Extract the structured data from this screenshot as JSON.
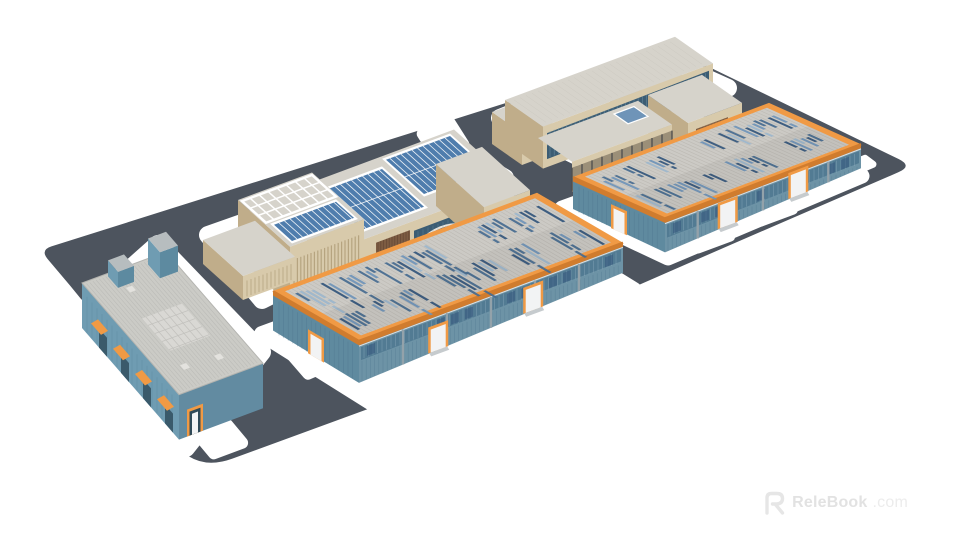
{
  "page": {
    "type": "3d-model-preview-render",
    "background": "#ffffff"
  },
  "watermark": {
    "brand": "ReleBook",
    "suffix": ".com"
  },
  "palette": {
    "page_bg": "#ffffff",
    "ground": "#4d545e",
    "pad_white": "#ffffff",
    "orange": "#f09a45",
    "orange_shade": "#d07c2e",
    "roof_gray": "#cccac5",
    "roof_line": "#bdbab4",
    "skylight_blue_1": "#6f94b8",
    "skylight_blue_2": "#476b90",
    "skylight_blue_3": "#9cb6cc",
    "skylight_blue_4": "#33567c",
    "wall_blue": "#6d93a6",
    "wall_blue_dark": "#5f8a9f",
    "window_band": "#527b93",
    "rib_dark": "#47708a",
    "post_gray": "#93a2aa",
    "door_white": "#f2f3f4",
    "beige": "#d8caab",
    "beige_shade": "#c0ad8a",
    "beige_dark": "#a8946f",
    "roof_office": "#d6d3cb",
    "glass_dark": "#3c5d74",
    "glass_light": "#7fa3b5",
    "wood": "#7d5c42",
    "wood_light": "#96714f",
    "solar_blue": "#4f7dad",
    "solar_grid": "#ffffff",
    "bluewh_wall": "#6f9cb2",
    "bluewh_wall_dark": "#5d8aa0",
    "bluewh_face_dark": "#628ba1",
    "bluewh_roof": "#cbcbc6",
    "bluewh_roof_line": "#bcbcb8",
    "watermark_gray": "#e2e2e2",
    "watermark_gray_light": "#ececec"
  },
  "buildings": [
    {
      "id": "office-north",
      "label": "beige administration building north"
    },
    {
      "id": "office-west",
      "label": "beige office building with rooftop solar panels"
    },
    {
      "id": "factory-east",
      "label": "factory hall east with orange trim"
    },
    {
      "id": "factory-center",
      "label": "factory hall center with orange trim"
    },
    {
      "id": "warehouse-south",
      "label": "blue warehouse south"
    }
  ]
}
